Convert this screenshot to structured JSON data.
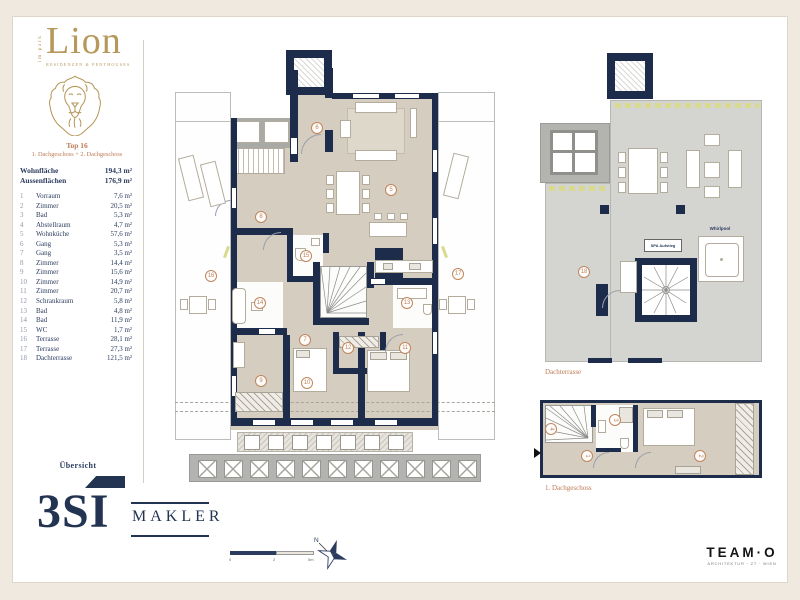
{
  "brand": {
    "vertical": "im park",
    "name": "Lion",
    "tagline": "RESIDENZEN & PENTHOUSES"
  },
  "unit": {
    "title": "Top 16",
    "subtitle": "1. Dachgeschoss + 2. Dachgeschoss"
  },
  "summary": [
    {
      "label": "Wohnfläche",
      "value": "194,3 m²"
    },
    {
      "label": "Aussenflächen",
      "value": "176,9 m²"
    }
  ],
  "rooms": [
    {
      "no": "1",
      "label": "Vorraum",
      "area": "7,6 m²"
    },
    {
      "no": "2",
      "label": "Zimmer",
      "area": "20,5 m²"
    },
    {
      "no": "3",
      "label": "Bad",
      "area": "5,3 m²"
    },
    {
      "no": "4",
      "label": "Abstellraum",
      "area": "4,7 m²"
    },
    {
      "no": "5",
      "label": "Wohnküche",
      "area": "57,6 m²"
    },
    {
      "no": "6",
      "label": "Gang",
      "area": "5,3 m²"
    },
    {
      "no": "7",
      "label": "Gang",
      "area": "3,5 m²"
    },
    {
      "no": "8",
      "label": "Zimmer",
      "area": "14,4 m²"
    },
    {
      "no": "9",
      "label": "Zimmer",
      "area": "15,6 m²"
    },
    {
      "no": "10",
      "label": "Zimmer",
      "area": "14,9 m²"
    },
    {
      "no": "11",
      "label": "Zimmer",
      "area": "20,7 m²"
    },
    {
      "no": "12",
      "label": "Schrankraum",
      "area": "5,8 m²"
    },
    {
      "no": "13",
      "label": "Bad",
      "area": "4,8 m²"
    },
    {
      "no": "14",
      "label": "Bad",
      "area": "11,9 m²"
    },
    {
      "no": "15",
      "label": "WC",
      "area": "1,7 m²"
    },
    {
      "no": "16",
      "label": "Terrasse",
      "area": "28,1 m²"
    },
    {
      "no": "17",
      "label": "Terrasse",
      "area": "27,3 m²"
    },
    {
      "no": "18",
      "label": "Dachterrasse",
      "area": "121,5 m²"
    }
  ],
  "overview": {
    "label": "Übersicht"
  },
  "broker": {
    "name": "3SI",
    "suffix": "MAKLER"
  },
  "architect": {
    "name": "TEAM·O",
    "tagline": "ARCHITEKTUR · ZT · WIEN"
  },
  "plans": {
    "main": {
      "rooms": [
        {
          "n": "6",
          "x": 142,
          "y": 78
        },
        {
          "n": "5",
          "x": 216,
          "y": 140
        },
        {
          "n": "8",
          "x": 86,
          "y": 167
        },
        {
          "n": "15",
          "x": 131,
          "y": 206
        },
        {
          "n": "16",
          "x": 36,
          "y": 226
        },
        {
          "n": "17",
          "x": 283,
          "y": 224
        },
        {
          "n": "14",
          "x": 85,
          "y": 253
        },
        {
          "n": "13",
          "x": 232,
          "y": 253
        },
        {
          "n": "7",
          "x": 130,
          "y": 290
        },
        {
          "n": "12",
          "x": 173,
          "y": 298
        },
        {
          "n": "11",
          "x": 230,
          "y": 298
        },
        {
          "n": "9",
          "x": 86,
          "y": 331
        },
        {
          "n": "10",
          "x": 132,
          "y": 333
        }
      ]
    },
    "roof": {
      "caption": "Dachterrasse",
      "whirlpool_label": "Whirlpool",
      "stair_label": "SPA Aufstieg",
      "rooms": [
        {
          "n": "18",
          "x": 44,
          "y": 222
        }
      ]
    },
    "first": {
      "caption": "1. Dachgeschoss",
      "rooms": [
        {
          "n": "4",
          "x": 16,
          "y": 31
        },
        {
          "n": "3",
          "x": 80,
          "y": 22
        },
        {
          "n": "1",
          "x": 52,
          "y": 58
        },
        {
          "n": "2",
          "x": 165,
          "y": 58
        }
      ]
    }
  },
  "scale": {
    "ticks": [
      "0",
      "2",
      "5m"
    ]
  },
  "compass": {
    "label": "N"
  }
}
